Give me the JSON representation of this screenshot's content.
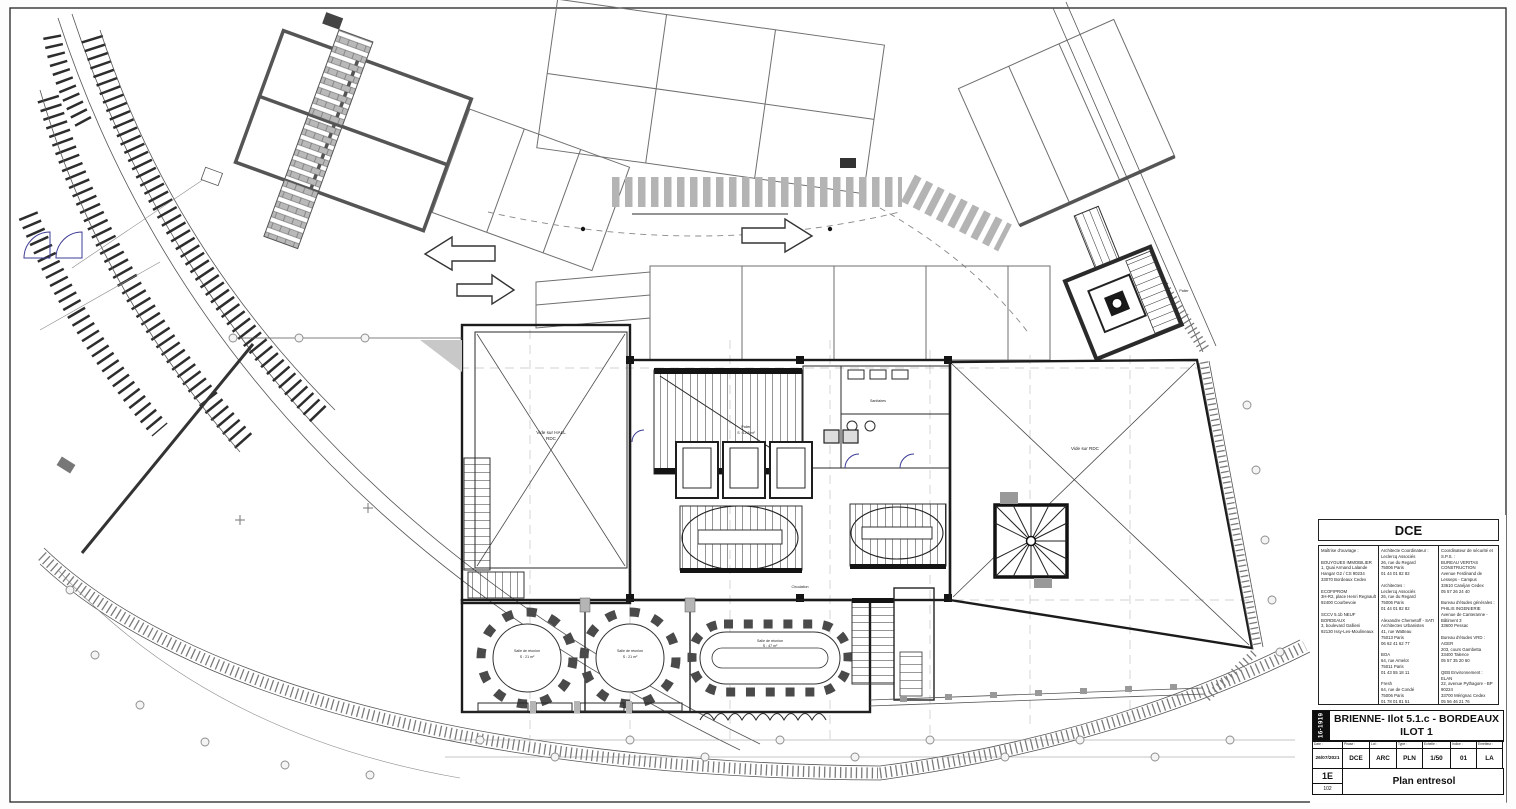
{
  "sheet": {
    "stage": "DCE",
    "project_code": "16-1919",
    "title_line1": "BRIENNE- Ilot 5.1.c - BORDEAUX",
    "title_line2": "ILOT 1",
    "drawing_title": "Plan entresol",
    "revision": "1E",
    "sheet_no": "102",
    "columns": [
      {
        "label": "Date :",
        "value": "26/07/2021"
      },
      {
        "label": "Phase :",
        "value": "DCE"
      },
      {
        "label": "Lot :",
        "value": "ARC"
      },
      {
        "label": "Type :",
        "value": "PLN"
      },
      {
        "label": "Echelle :",
        "value": "1/50"
      },
      {
        "label": "Indice :",
        "value": "01"
      },
      {
        "label": "Emetteur :",
        "value": "LA"
      }
    ],
    "contacts": {
      "col1": "Maîtrise d'ouvrage :\n\nBOUYGUES IMMOBILIER\n1, Quai Armand Lalande\nHangar G2 / CS 90234\n33070 Bordeaux Cedex\n\nECOFIPROM\n3H-R2, place Henri Regnault\n92400 Courbevoie\n\nSCCV 5.1b NEUF BORDEAUX\n3, boulevard Gallieni\n92130 Issy-Les-Moulineaux",
      "col2": "Architecte Coordinateur :\nLeclercq Associés\n26, rue du Regard\n75006 Paris\n01 44 01 82 82\n\nArchitectes :\nLeclercq Associés\n26, rue du Regard\n75006 Paris\n01 44 01 82 82\n\nAlexandre Chemetoff - SATI\nArchitectes Urbanistes\n41, rue Watteau\n75013 Paris\n06 62 41 62 77\n\nBOA\n64, rue Amelot\n75011 Paris\n01 43 55 18 11\n\nFresh\n64, rue de Condé\n75006 Paris\n01 78 01 81 51\n\nAtelier Stéphane Fernandez\n595, chemin Pierre Plumade\n13100 Aix en Provence\n04 42 96 07 14",
      "col3": "Coordinateur de sécurité et S.P.S. :\nBUREAU VERITAS CONSTRUCTION\nAvenue Ferdinand de Lesseps - Campus\n33610 Canéjan Cedex\n05 57 26 24 40\n\nBureau d'études générales :\nPHILIS INGENIERIE\nAvenue de Canteranne - Bâtiment 3\n33600 Pessac\n\nBureau d'études VRD :\nAGER\n203, cours Gambetta\n33400 Talence\n05 57 35 20 60\n\nQEB Environnement :\nELAN\n22, avenue Pythagore - BP 90224\n33700 Mérignac Cedex\n05 56 46 21 76\n\nBureau d'études SSI et ECSP :\nCSD\n30, avenue Hubert Dubedout\n38000 Grenoble\n05 57 04 30 60"
    }
  },
  "plan_labels": {
    "vide_hall_line1": "Vide sur HALL",
    "vide_hall_line2": "RDC",
    "vide_rdc": "Vide sur RDC",
    "palier_top": "Palier",
    "core_room": "Palier",
    "core_area": "S : 12.5 m²",
    "wc": "Sanitaires",
    "circulation": "Circulation",
    "room1_name": "Salle de réunion",
    "room1_area": "S : 21 m²",
    "room2_name": "Salle de réunion",
    "room2_area": "S : 21 m²",
    "room3_name": "Salle de réunion",
    "room3_area": "S : 47 m²"
  }
}
